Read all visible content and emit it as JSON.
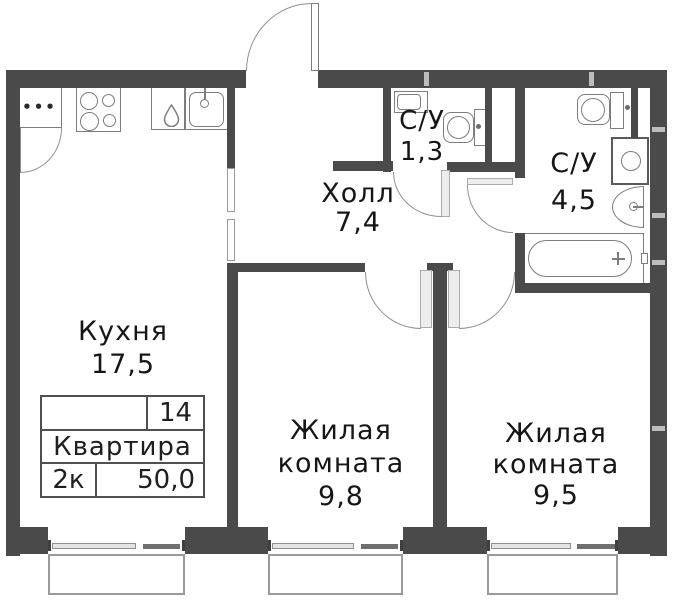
{
  "plan": {
    "rooms": [
      {
        "name": "Кухня",
        "area": "17,5"
      },
      {
        "name": "Холл",
        "area": "7,4"
      },
      {
        "name": "С/У",
        "area": "1,3"
      },
      {
        "name": "С/У",
        "area": "4,5"
      },
      {
        "name": "Жилая",
        "name2": "комната",
        "area": "9,8"
      },
      {
        "name": "Жилая",
        "name2": "комната",
        "area": "9,5"
      }
    ],
    "info_table": {
      "number": "14",
      "title": "Квартира",
      "type": "2к",
      "area": "50,0"
    },
    "fridge_dots": "•••",
    "icons": {
      "fridge": "rect+dots",
      "stove": "four-burner-circles",
      "kitchen-sink": "rounded-rect+tap",
      "water-drop": "svg-droplet-outline",
      "toilet": "bowl+cistern",
      "washbasin-corner": "rect-inset",
      "washbasin-round": "half-ellipse+tap-cross",
      "washing-machine": "square+circle",
      "bathtub": "rect+stadium+drain-cross",
      "door-swing": "quarter-arc+leaf",
      "window": "double-glass-line+sill"
    },
    "colors": {
      "wall": "#4a4a4a",
      "fixture_line": "#7d7d7d",
      "door_arc": "#909090",
      "leaf_fill": "#ededed",
      "window_sill": "#9a9a9a",
      "text": "#161616"
    }
  }
}
